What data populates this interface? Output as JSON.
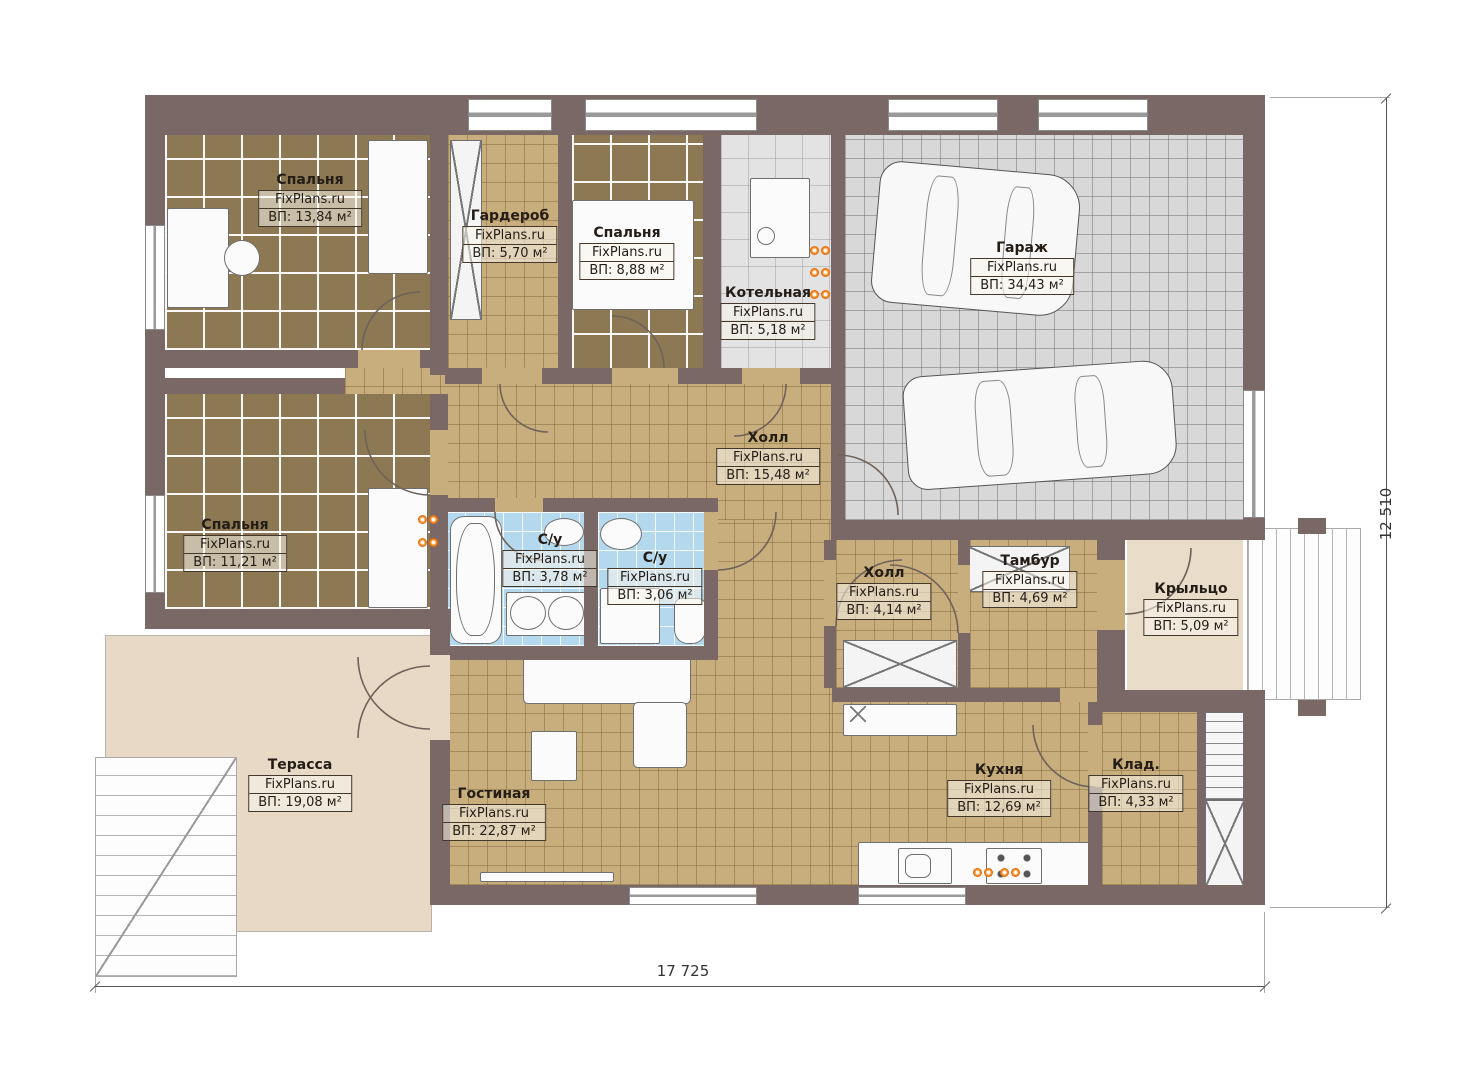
{
  "site": "FixPlans.ru",
  "rooms": [
    {
      "name": "Спальня",
      "area": "ВП: 13,84 м²"
    },
    {
      "name": "Гардероб",
      "area": "ВП: 5,70 м²"
    },
    {
      "name": "Спальня",
      "area": "ВП: 8,88 м²"
    },
    {
      "name": "Котельная",
      "area": "ВП: 5,18 м²"
    },
    {
      "name": "Гараж",
      "area": "ВП: 34,43 м²"
    },
    {
      "name": "Холл",
      "area": "ВП: 15,48 м²"
    },
    {
      "name": "Спальня",
      "area": "ВП: 11,21 м²"
    },
    {
      "name": "С/у",
      "area": "ВП: 3,78 м²"
    },
    {
      "name": "С/у",
      "area": "ВП: 3,06 м²"
    },
    {
      "name": "Холл",
      "area": "ВП: 4,14 м²"
    },
    {
      "name": "Тамбур",
      "area": "ВП: 4,69 м²"
    },
    {
      "name": "Крыльцо",
      "area": "ВП: 5,09 м²"
    },
    {
      "name": "Терасса",
      "area": "ВП: 19,08 м²"
    },
    {
      "name": "Гостиная",
      "area": "ВП: 22,87 м²"
    },
    {
      "name": "Кухня",
      "area": "ВП: 12,69 м²"
    },
    {
      "name": "Клад.",
      "area": "ВП: 4,33 м²"
    }
  ],
  "dimensions": {
    "width": "17 725",
    "height": "12 510"
  },
  "colors": {
    "wall": "#7a6867",
    "floor_tan": "#c8ae7d",
    "floor_dark": "#8c7852",
    "floor_garage": "#d8d8d8",
    "floor_bath": "#b4d8ee",
    "terrace": "#e7d9c5",
    "radiator": "#e05e00"
  }
}
